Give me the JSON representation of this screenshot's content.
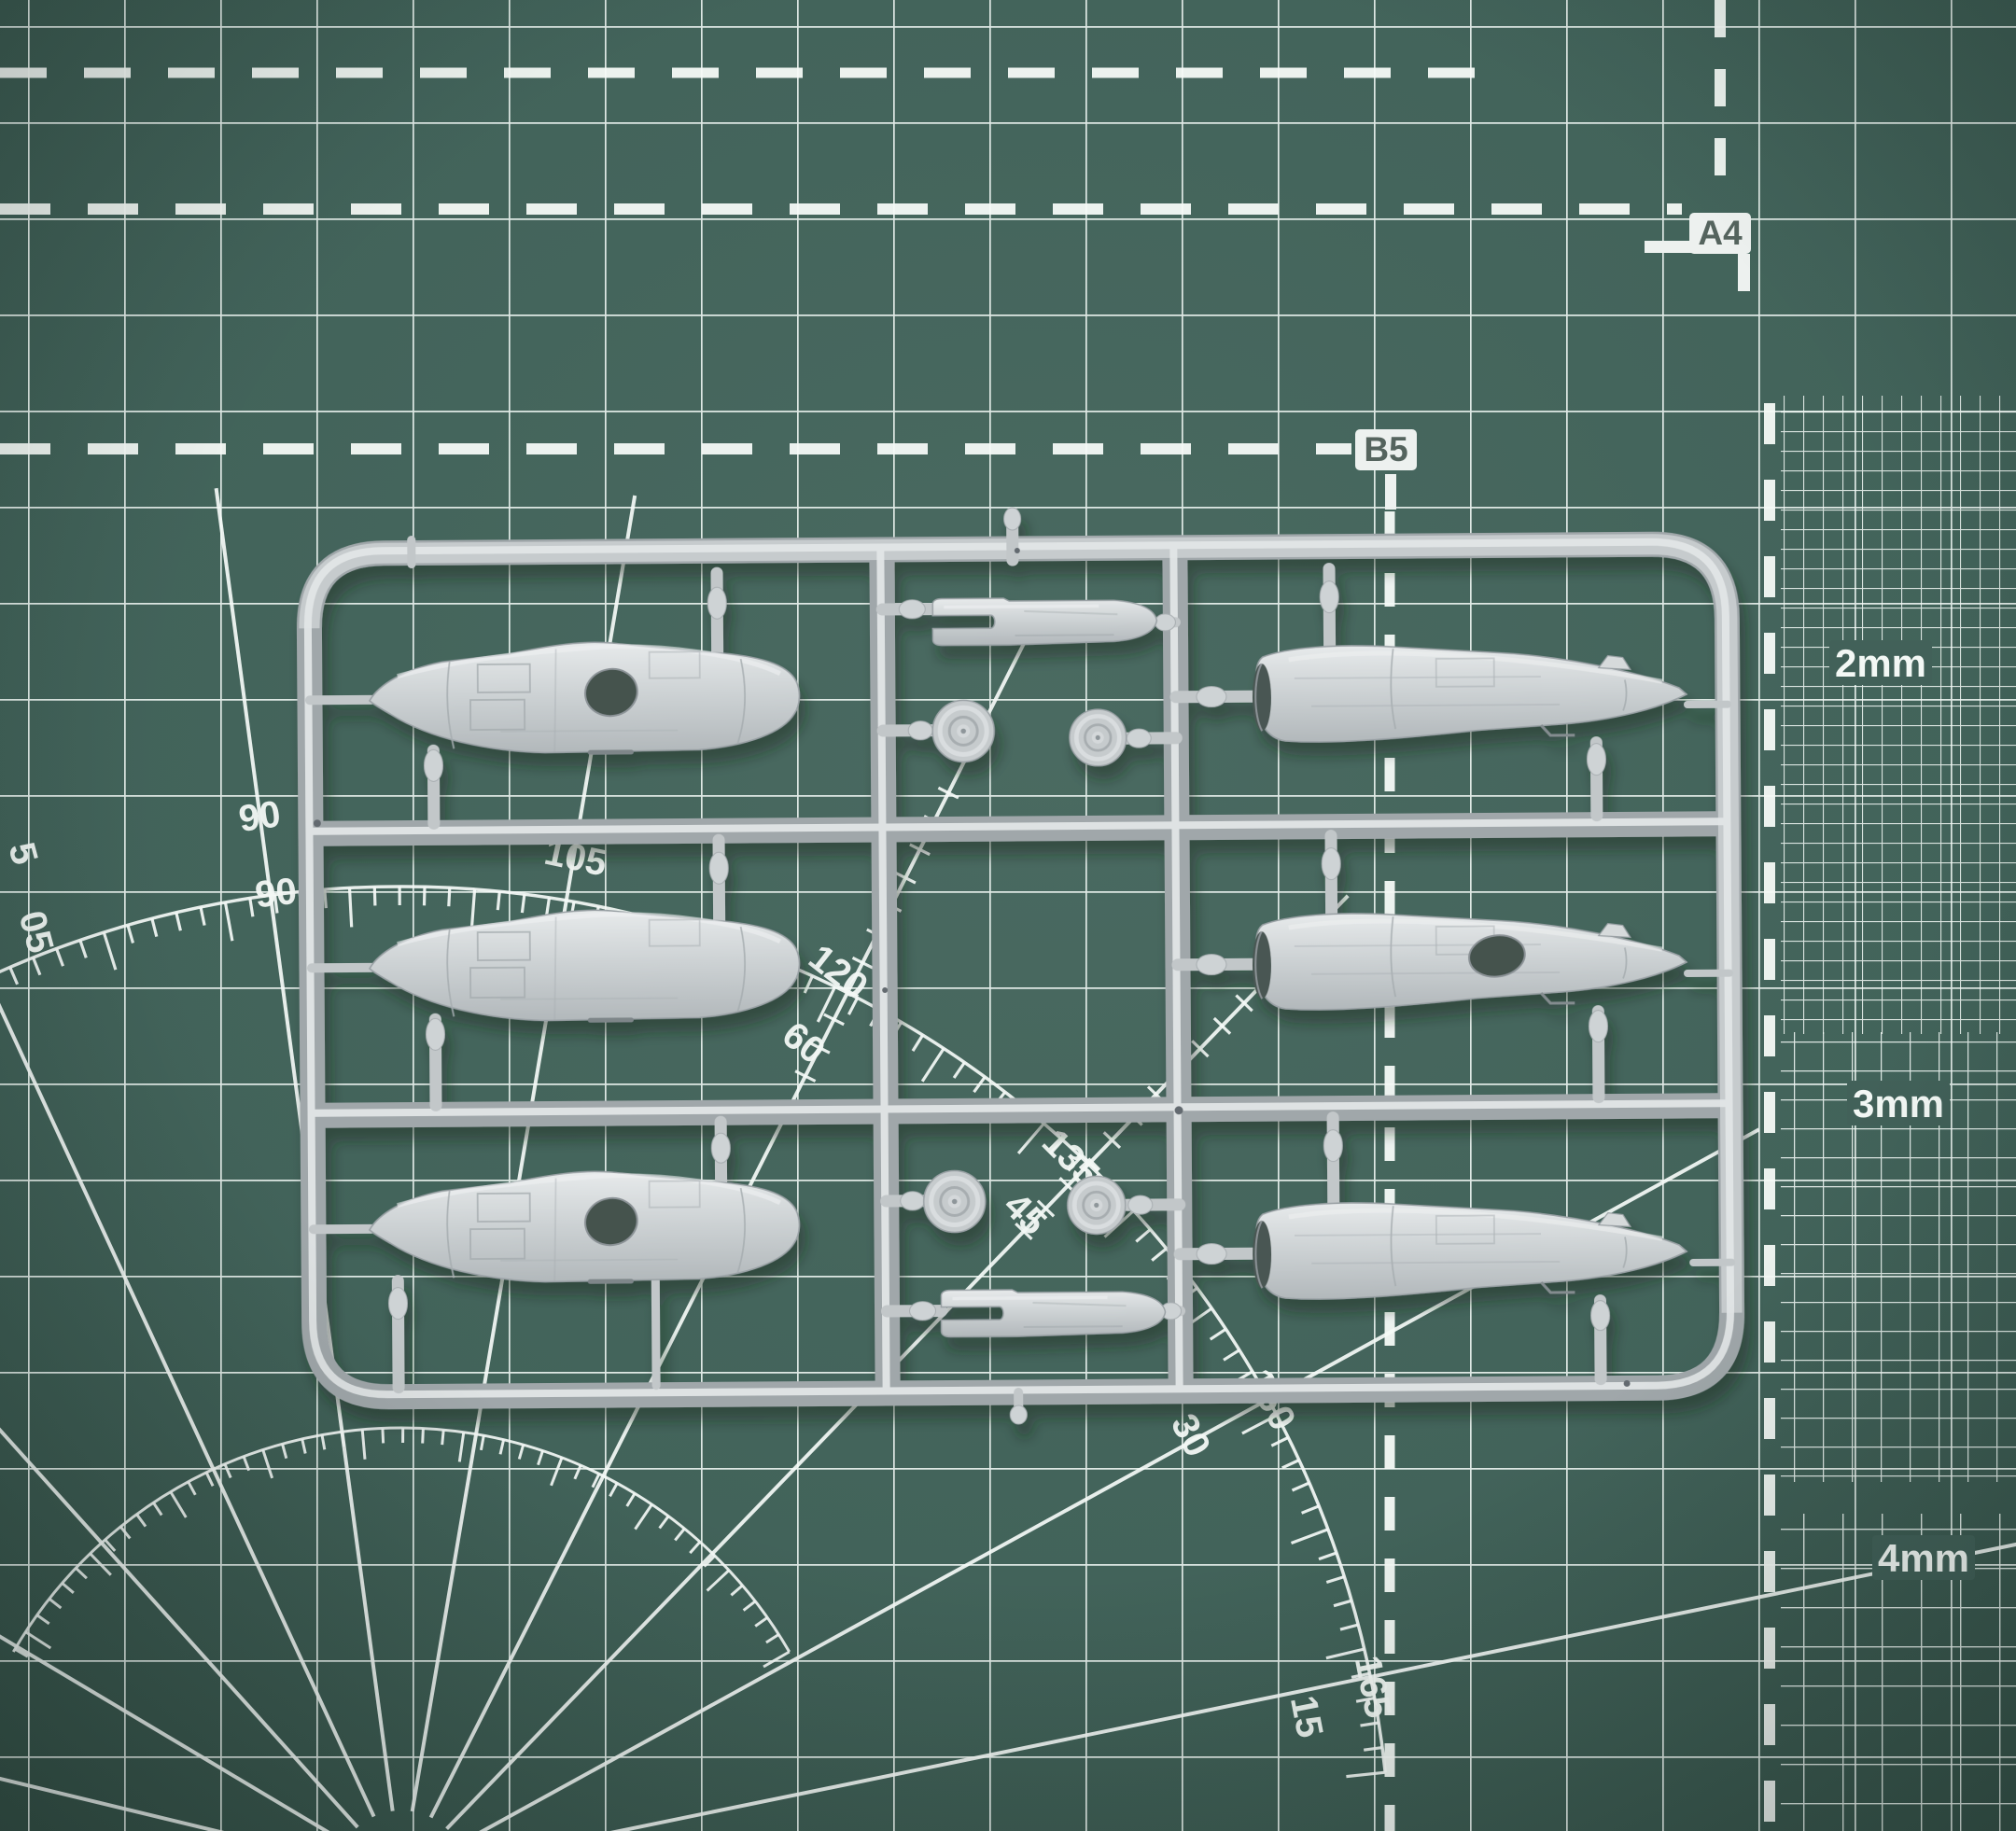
{
  "mat": {
    "labels": {
      "a4": "A4",
      "b5": "B5",
      "mm2": "2mm",
      "mm3": "3mm",
      "mm4": "4mm",
      "deg_outer_90": "90",
      "deg_outer_105": "105",
      "deg_outer_120": "120",
      "deg_outer_135": "135",
      "deg_outer_150": "150",
      "deg_outer_165": "165",
      "deg_inner_90": "90",
      "deg_inner_60": "60",
      "deg_inner_45": "45",
      "deg_inner_30": "30",
      "deg_inner_15": "15",
      "deg_edge_75_partial": "5",
      "deg_edge_105_partial": "05"
    },
    "colors": {
      "mat_green": "#44655c",
      "mat_green_dark": "#31493f",
      "line_white": "#f3f8f5",
      "chip_bg": "#edf1ef",
      "chip_text": "#55645e"
    }
  },
  "sprue": {
    "colors": {
      "plastic_base": "#c6cbcd",
      "plastic_highlight": "#e9ecec",
      "plastic_shadow": "#9aa1a5"
    },
    "parts": {
      "fuselage_halves": 6,
      "wheels": 4,
      "tail_booms": 2
    }
  }
}
